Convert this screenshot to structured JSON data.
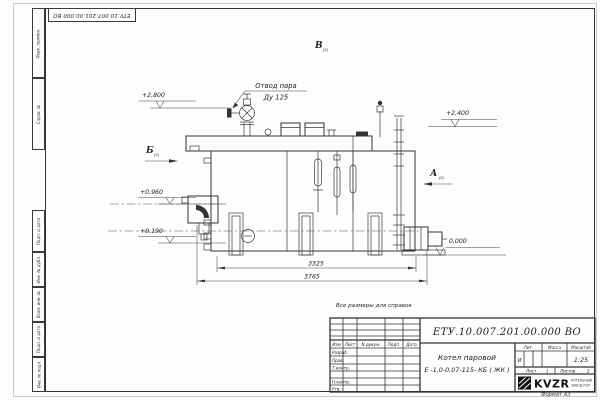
{
  "sheet": {
    "format_label": "Формат А3",
    "reference_note": "Все размеры для справок"
  },
  "corner_stamp": {
    "doc_number": "ЕТУ.10.007.201.00.000  ВО"
  },
  "margin_labels": {
    "perv_primen": "Перв. примен.",
    "sprav_no": "Справ. №",
    "podp_i_data_1": "Подп. и дата",
    "inv_no_dubl": "Инв. № дубл.",
    "vzam_inv_no": "Взам. инв. №",
    "podp_i_data_2": "Подп. и дата",
    "inv_no_podl": "Инв. № подл."
  },
  "drawing": {
    "callout_line1": "Отвод пара",
    "callout_line2": "Ду 125",
    "elev_plus_2800": "+2,800",
    "elev_plus_2400": "+2,400",
    "elev_plus_0960": "+0,960",
    "elev_plus_0190": "+0,190",
    "elev_zero": "0,000",
    "view_b": "Б",
    "view_v": "В",
    "view_a": "А",
    "view_sheet_ref": "(2)",
    "dim_3325": "3325",
    "dim_3765": "3765"
  },
  "title_block": {
    "doc_number": "ЕТУ.10.007.201.00.000  ВО",
    "product_line1": "Котел паровой",
    "product_line2": "Е -1,0-0,07-115- КБ ( ЖК )",
    "col_izm": "Изм",
    "col_list": "Лист",
    "col_n_dokum": "N докум.",
    "col_podp": "Подп.",
    "col_data": "Дата",
    "row_razrab": "Разраб.",
    "row_prov": "Пров.",
    "row_t_kontr": "Т.контр.",
    "row_n_kontr": "Н.контр.",
    "row_utv": "Утв.",
    "lit_label": "Лит.",
    "lit_value": "И",
    "mass_label": "Масса",
    "scale_label": "Масштаб",
    "scale_value": "1:25",
    "sheet_label": "Лист",
    "sheet_value": "1",
    "sheets_label": "Листов",
    "sheets_value": "2",
    "logo_text": "KVZR",
    "logo_line1": "КОТЕЛЬНЫЙ",
    "logo_line2": "ЗАВОД РЭП"
  },
  "colors": {
    "line": "#333333",
    "paper": "#fdfdfc"
  }
}
